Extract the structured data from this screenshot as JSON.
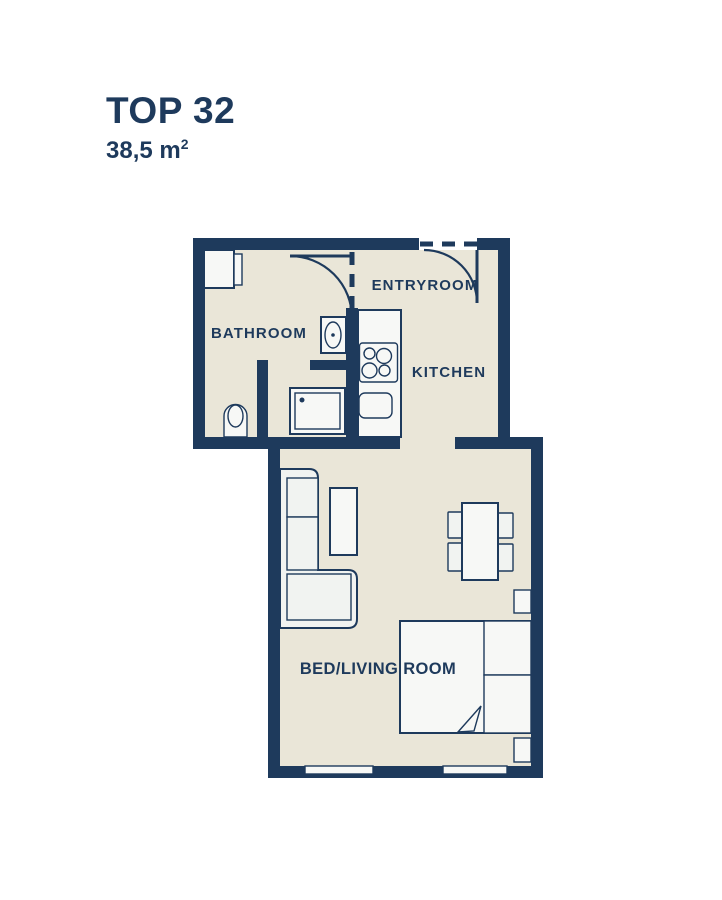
{
  "header": {
    "title": "TOP 32",
    "area_value": "38,5 m",
    "area_superscript": "2"
  },
  "floorplan": {
    "rooms": [
      {
        "id": "bathroom",
        "label": "BATHROOM"
      },
      {
        "id": "entryroom",
        "label": "ENTRYROOM"
      },
      {
        "id": "kitchen",
        "label": "KITCHEN"
      },
      {
        "id": "bed_living_room",
        "label": "BED/LIVING ROOM"
      }
    ],
    "fixtures": [
      "washing-machine",
      "washbasin",
      "shower",
      "toilet",
      "bathroom-door",
      "entry-door",
      "kitchen-counter",
      "stove",
      "kitchen-sink",
      "sofa",
      "side-table",
      "dining-table",
      "dining-chair",
      "bed",
      "pillow",
      "blanket-fold",
      "nightstand",
      "window"
    ]
  },
  "colors": {
    "wall_navy": "#1e3a5c",
    "floor_beige": "#eae6d8",
    "fixture_fill": "#f7f8f6",
    "furniture_fill": "#f1f3f1",
    "page_background": "#ffffff",
    "text_navy": "#1e3a5c"
  }
}
